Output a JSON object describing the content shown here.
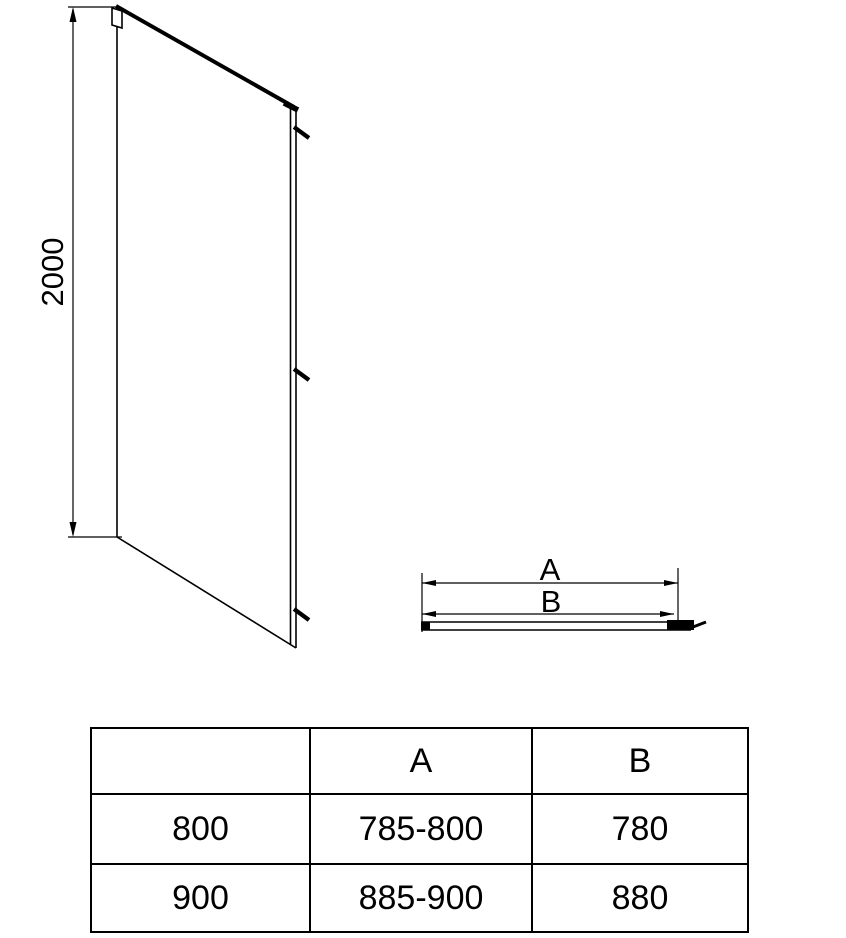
{
  "drawing": {
    "height_dim_label": "2000",
    "top_view": {
      "dim_a_label": "A",
      "dim_b_label": "B"
    }
  },
  "spec_table": {
    "headers": [
      "",
      "A",
      "B"
    ],
    "rows": [
      [
        "800",
        "785-800",
        "780"
      ],
      [
        "900",
        "885-900",
        "880"
      ]
    ]
  },
  "colors": {
    "line": "#000000",
    "background": "#ffffff",
    "text": "#000000"
  }
}
